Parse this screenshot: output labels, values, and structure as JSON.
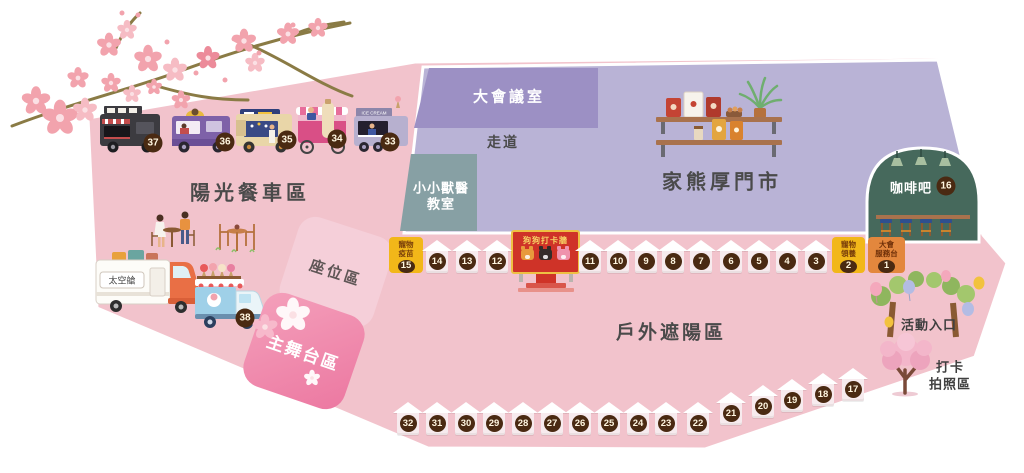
{
  "areas": {
    "food_truck_zone": {
      "label": "陽光餐車區"
    },
    "meeting_room": {
      "label": "大會議室"
    },
    "walkway": {
      "label": "走道"
    },
    "vet_classroom": {
      "line1": "小小獸醫",
      "line2": "教室"
    },
    "store": {
      "label": "家熊厚門市"
    },
    "coffee_bar": {
      "label": "咖啡吧",
      "number": "16"
    },
    "seating_area": {
      "label": "座位區"
    },
    "main_stage": {
      "label": "主舞台區"
    },
    "outdoor_shade": {
      "label": "戶外遮陽區"
    },
    "entrance": {
      "label": "活動入口"
    },
    "photo_zone": {
      "line1": "打卡",
      "line2": "拍照區"
    },
    "space_capsule": {
      "label": "太空艙"
    },
    "dog_photo_wall": {
      "label": "狗狗打卡牆"
    }
  },
  "booths": {
    "pet_vaccine": {
      "line1": "寵物",
      "line2": "疫苗",
      "number": "15"
    },
    "pet_adoption": {
      "line1": "寵物",
      "line2": "領養",
      "number": "2"
    },
    "service_desk": {
      "line1": "大會",
      "line2": "服務台",
      "number": "1"
    }
  },
  "tents": {
    "row1": [
      "14",
      "13",
      "12",
      "11",
      "10",
      "9",
      "8",
      "7",
      "6",
      "5",
      "4",
      "3"
    ],
    "row2": [
      "32",
      "31",
      "30",
      "29",
      "28",
      "27",
      "26",
      "25",
      "24",
      "23",
      "22",
      "21",
      "20",
      "19",
      "18",
      "17"
    ]
  },
  "food_trucks": [
    "37",
    "36",
    "35",
    "34",
    "33"
  ],
  "ice_cream_truck": {
    "number": "38"
  },
  "decor": {
    "ice_cream_sign": "ICE CREAM"
  },
  "colors": {
    "map_pink": "#f2c3cc",
    "indoor_purple": "#b9b3d6",
    "meeting_purple": "#9c90c4",
    "classroom_teal": "#87a0a4",
    "coffee_green": "#46695c",
    "stage_pink": "#ec78a1",
    "seating_pink": "#f5cfd9",
    "badge_brown": "#4a2a12",
    "booth_yellow": "#f2b719",
    "booth_orange": "#e3873d",
    "wall_red": "#cf3328"
  }
}
